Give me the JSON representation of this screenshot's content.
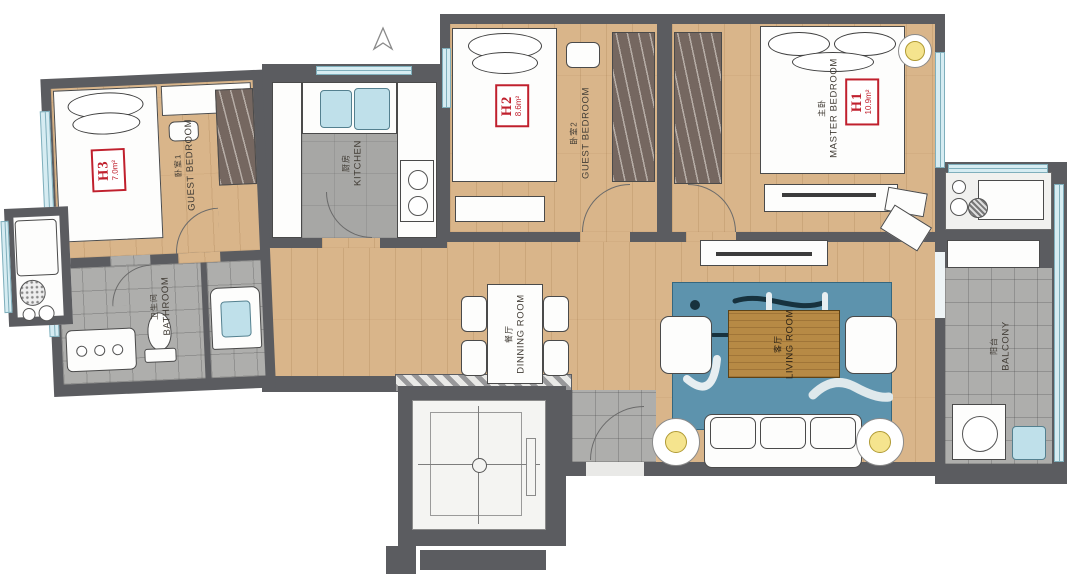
{
  "plan_type": "residential-apartment-floor-plan",
  "rooms": {
    "guest_bedroom_1": {
      "name_cn": "卧室1",
      "name_en": "GUEST BEDROOM",
      "unit_code": "H3",
      "unit_area": "7.0m²"
    },
    "guest_bedroom_2": {
      "name_cn": "卧室2",
      "name_en": "GUEST BEDROOM",
      "unit_code": "H2",
      "unit_area": "8.6m²"
    },
    "master_bedroom": {
      "name_cn": "主卧",
      "name_en": "MASTER BEDROOM",
      "unit_code": "H1",
      "unit_area": "10.9m²"
    },
    "kitchen": {
      "name_cn": "厨房",
      "name_en": "KITCHEN"
    },
    "bathroom": {
      "name_cn": "卫生间",
      "name_en": "BATHROOM"
    },
    "dining_room": {
      "name_cn": "餐厅",
      "name_en": "DINNING ROOM"
    },
    "living_room": {
      "name_cn": "客厅",
      "name_en": "LIVING ROOM"
    },
    "balcony": {
      "name_cn": "阳台",
      "name_en": "BALCONY"
    }
  },
  "colors": {
    "wall": "#5b5c60",
    "wood_floor": "#d9b58a",
    "tile_gray": "#aeaeac",
    "window_blue": "#d6ecf2",
    "area_label_red": "#c0202d",
    "rug_blue": "#5d93ad",
    "wardrobe_brown": "#756760",
    "coffee_table_wood": "#b78a45",
    "lamp_yellow": "#f5e48e"
  }
}
